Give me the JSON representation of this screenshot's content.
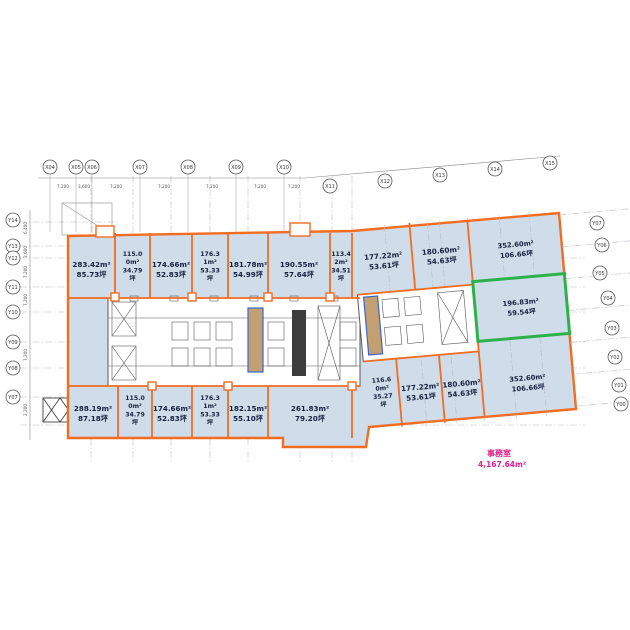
{
  "title": "office-floor-plan",
  "colors": {
    "outline_orange": "#f26c21",
    "room_fill": "#cfdce9",
    "highlight_green": "#2db14a",
    "core_line": "#5a5a5a",
    "shaft_fill": "#c2a071",
    "shaft_border": "#3f64c8",
    "note_pink": "#e0218a",
    "grid_gray": "#b9bec4",
    "label_navy": "#16233e"
  },
  "rooms_top": [
    {
      "m2": "283.42m²",
      "tsubo": "85.73坪"
    },
    {
      "m2": "115.00m²",
      "tsubo": "34.79坪"
    },
    {
      "m2": "174.66m²",
      "tsubo": "52.83坪"
    },
    {
      "m2": "176.31m²",
      "tsubo": "53.33坪"
    },
    {
      "m2": "181.78m²",
      "tsubo": "54.99坪"
    },
    {
      "m2": "190.55m²",
      "tsubo": "57.64坪"
    },
    {
      "m2": "113.42m²",
      "tsubo": "34.51坪"
    },
    {
      "m2": "177.22m²",
      "tsubo": "53.61坪"
    },
    {
      "m2": "180.60m²",
      "tsubo": "54.63坪"
    },
    {
      "m2": "352.60m²",
      "tsubo": "106.66坪"
    }
  ],
  "rooms_bottom": [
    {
      "m2": "288.19m²",
      "tsubo": "87.18坪"
    },
    {
      "m2": "115.00m²",
      "tsubo": "34.79坪"
    },
    {
      "m2": "174.66m²",
      "tsubo": "52.83坪"
    },
    {
      "m2": "176.31m²",
      "tsubo": "53.33坪"
    },
    {
      "m2": "182.15m²",
      "tsubo": "55.10坪"
    },
    {
      "m2": "261.83m²",
      "tsubo": "79.20坪"
    },
    {
      "m2": "116.60m²",
      "tsubo": "35.27坪"
    },
    {
      "m2": "177.22m²",
      "tsubo": "53.61坪"
    },
    {
      "m2": "180.60m²",
      "tsubo": "54.63坪"
    },
    {
      "m2": "352.60m²",
      "tsubo": "106.66坪"
    }
  ],
  "highlight_room": {
    "m2": "196.83m²",
    "tsubo": "59.54坪"
  },
  "note": {
    "label": "事務室",
    "area": "4,167.64m²"
  },
  "grid": {
    "top_labels": [
      "X04",
      "X05",
      "X06",
      "X07",
      "X08",
      "X09",
      "X10",
      "X11",
      "X12",
      "X13",
      "X14",
      "X15"
    ],
    "left_labels": [
      "Y14",
      "Y13",
      "Y12",
      "Y11",
      "Y10",
      "Y09",
      "Y08",
      "Y07"
    ],
    "right_labels": [
      "Y07",
      "Y06",
      "Y05",
      "Y04",
      "Y03",
      "Y02",
      "Y01",
      "Y00"
    ],
    "top_dims": [
      "7,200",
      "3,600",
      "7,200",
      "7,200",
      "7,200",
      "7,200",
      "7,200",
      "6,400"
    ],
    "left_dims": [
      "6,400",
      "3,600",
      "7,200",
      "7,200",
      "7,200",
      "2,200"
    ]
  }
}
